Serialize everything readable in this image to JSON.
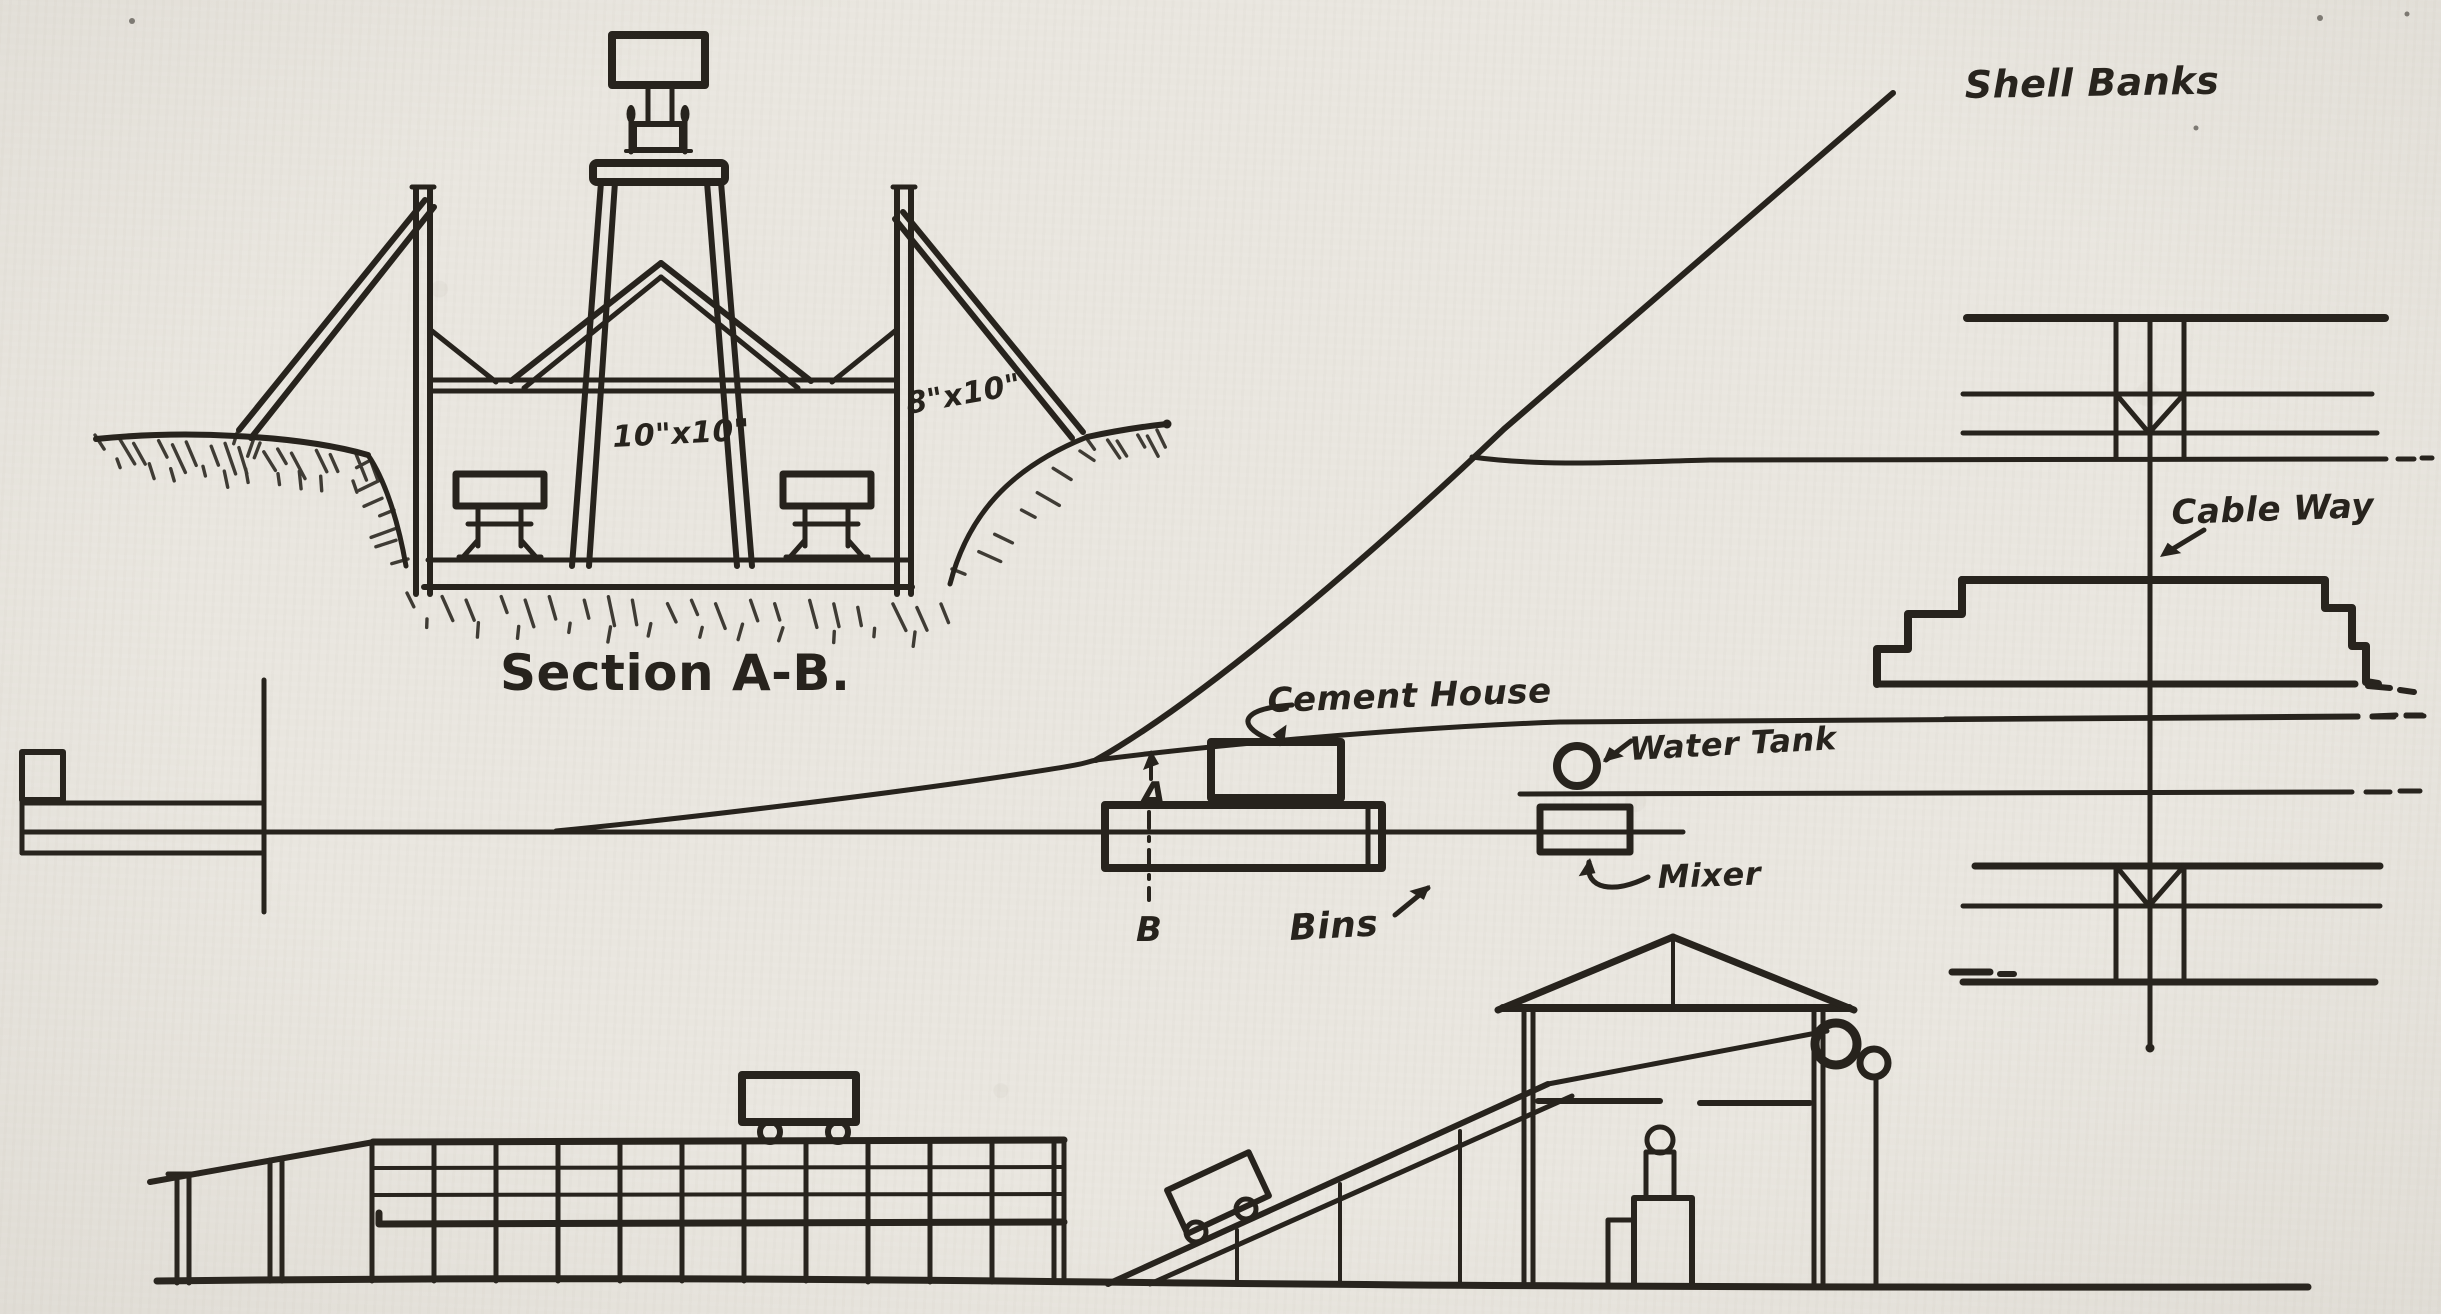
{
  "drawing": {
    "labels": {
      "section_title": "Section A-B.",
      "dim_10x10": "10\"x10\"",
      "dim_8x10": "8\"x10\"",
      "shell_banks": "Shell Banks",
      "cable_way": "Cable Way",
      "cement_house": "Cement House",
      "water_tank": "Water Tank",
      "bins": "Bins",
      "mixer": "Mixer",
      "point_a": "A",
      "point_b": "B"
    },
    "colors": {
      "ink": "#27231d",
      "paper": "#e9e6df"
    }
  }
}
